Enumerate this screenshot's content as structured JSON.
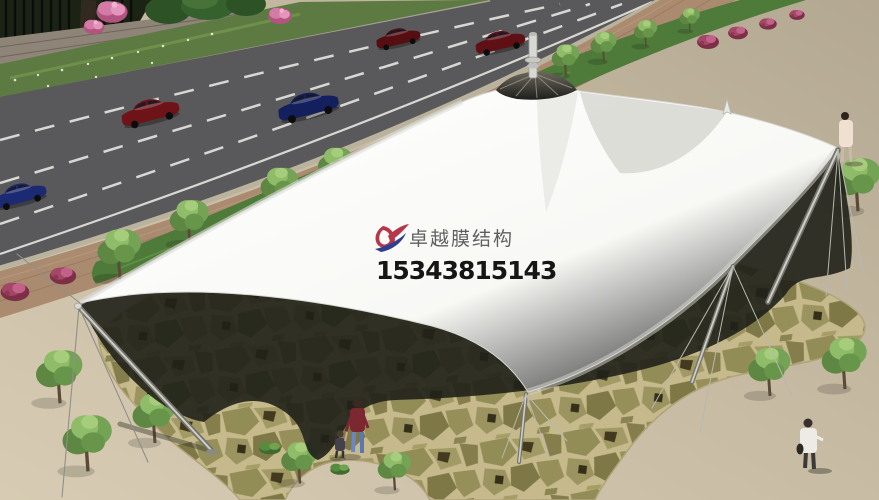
{
  "meta": {
    "kind": "architectural-rendering",
    "description": "3D rendering of a white tensile membrane umbrella canopy on a stone-paved plaza beside a multi-lane road with cars, street trees and pedestrians"
  },
  "watermark": {
    "company_name": "卓越膜结构",
    "phone": "15343815143"
  },
  "logo": {
    "name": "brand-swoosh-logo",
    "red": "#b5374a",
    "blue": "#2f3f8f"
  },
  "palette": {
    "plaza": "#c7bba3",
    "road": "#59595b",
    "road_line": "#ededea",
    "sidewalk": "#ab8b70",
    "grass": "#4e7a3a",
    "flagstone_joint": "#c6b98c",
    "shadow": "#20211a",
    "membrane_white": "#fbfbf8",
    "mast": "#74746c",
    "wall": "#8e8478",
    "fence": "#1b2414",
    "bush_magenta": "#8e3550",
    "bush_pink": "#cf6f9e",
    "tree_green": "#74a355",
    "car_dark_red": "#6e1317",
    "car_navy": "#18245f"
  },
  "scene": {
    "canopy": {
      "type": "tensile membrane umbrella",
      "peaks": 1,
      "edge_masts": 4,
      "color": "white"
    },
    "vehicles": [
      "dark-red-sedan",
      "navy-sedan",
      "dark-red-sedan",
      "dark-red-sedan",
      "navy-sedan"
    ],
    "pedestrians": [
      "woman-in-red-top-with-child",
      "child",
      "walker-north-plaza",
      "walker-south-plaza"
    ]
  }
}
